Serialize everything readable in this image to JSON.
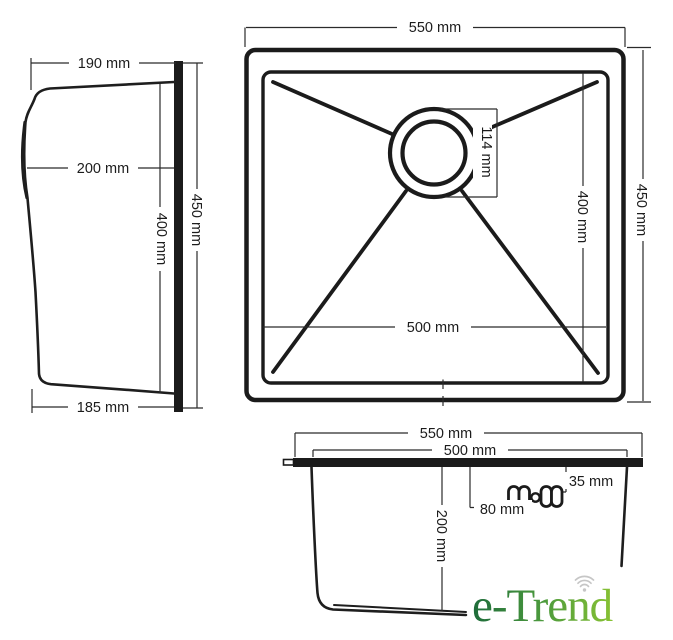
{
  "drawing_title": "sink dimension drawing",
  "side_view": {
    "label_top_width": "190 mm",
    "label_upper_depth": "200 mm",
    "label_inner_height": "400 mm",
    "label_overall_height": "450 mm",
    "label_bottom_width": "185 mm"
  },
  "top_view": {
    "label_overall_width": "550 mm",
    "label_drain_diameter": "114 mm",
    "label_bowl_depth": "400 mm",
    "label_overall_depth": "450 mm",
    "label_bowl_width": "500 mm"
  },
  "section_view": {
    "label_overall_width": "550 mm",
    "label_bowl_width": "500 mm",
    "label_hole_offset": "35 mm",
    "label_hole_spacing": "80 mm",
    "label_bowl_height": "200 mm"
  },
  "logo": {
    "text": "e-Trend",
    "gradient_start": "#1d6b3a",
    "gradient_mid": "#4c9a3d",
    "gradient_end": "#94ca32",
    "icon_color": "#c6c6c6"
  },
  "line_color": "#1e1e1e"
}
